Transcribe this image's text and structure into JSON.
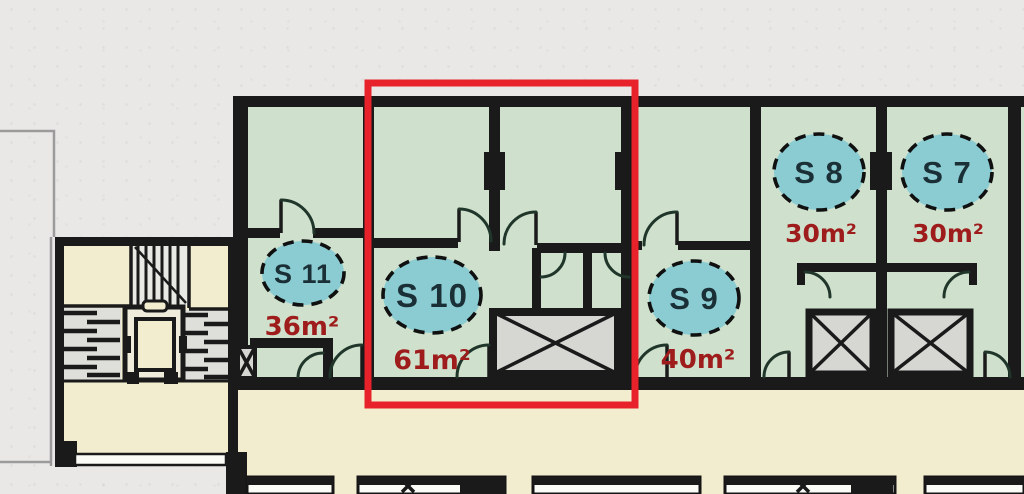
{
  "plan": {
    "type": "apartment-floor-plan",
    "highlighted_unit": "S 10",
    "units": [
      {
        "id": "S11",
        "label": "S 11",
        "area": "36m²",
        "highlighted": false
      },
      {
        "id": "S10",
        "label": "S 10",
        "area": "61m²",
        "highlighted": true
      },
      {
        "id": "S9",
        "label": "S 9",
        "area": "40m²",
        "highlighted": false
      },
      {
        "id": "S8",
        "label": "S 8",
        "area": "30m²",
        "highlighted": false
      },
      {
        "id": "S7",
        "label": "S 7",
        "area": "30m²",
        "highlighted": false
      }
    ],
    "colors": {
      "background": "#e9e8e6",
      "room_fill": "#cfe1cd",
      "corridor_fill": "#f2edcf",
      "wall": "#1a1a1a",
      "badge_fill": "#8accd2",
      "badge_border": "#101010",
      "badge_text": "#1b2f37",
      "area_text": "#9e1c1c",
      "highlight_box": "#e8222a",
      "shaft_fill": "#d6d6d3"
    },
    "features": [
      "stairwell",
      "elevator",
      "corridor",
      "duct-shafts"
    ]
  }
}
